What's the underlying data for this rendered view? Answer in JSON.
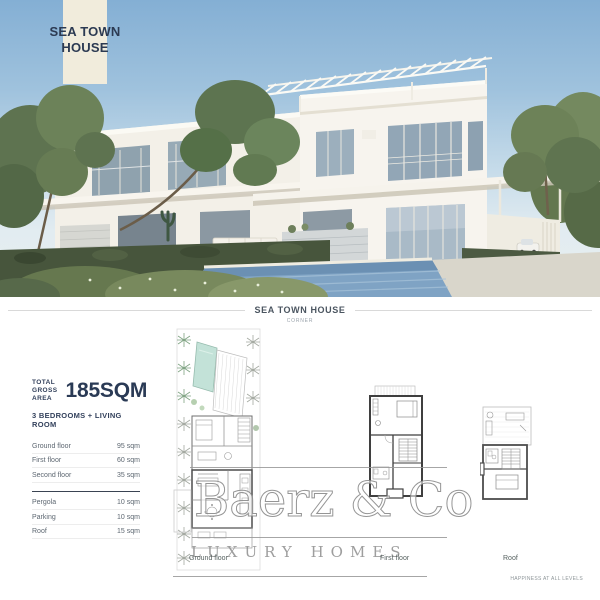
{
  "badge": {
    "title_line1": "SEA TOWN",
    "title_line2": "HOUSE"
  },
  "caption": {
    "title": "SEA TOWN HOUSE",
    "subtitle": "CORNER"
  },
  "summary": {
    "total_label_line1": "TOTAL",
    "total_label_line2": "GROSS AREA",
    "total_value": "185SQM",
    "configuration": "3 BEDROOMS + LIVING ROOM"
  },
  "area_table": {
    "floors": [
      {
        "label": "Ground floor",
        "value": "95 sqm"
      },
      {
        "label": "First floor",
        "value": "60 sqm"
      },
      {
        "label": "Second floor",
        "value": "35 sqm"
      }
    ],
    "extras": [
      {
        "label": "Pergola",
        "value": "10 sqm"
      },
      {
        "label": "Parking",
        "value": "10 sqm"
      },
      {
        "label": "Roof",
        "value": "15 sqm"
      }
    ]
  },
  "floor_plans": [
    {
      "label": "Ground floor"
    },
    {
      "label": "First floor"
    },
    {
      "label": "Roof"
    }
  ],
  "watermark": {
    "brand": "Baerz & Co",
    "tagline": "LUXURY HOMES"
  },
  "footer": {
    "slogan": "HAPPINESS AT ALL LEVELS"
  },
  "colors": {
    "badge_bg": "#f1ecdc",
    "heading_navy": "#2a3a55",
    "plan_pool": "#c3e2d8",
    "photo_pool": "#7fa3c4",
    "sky_top": "#84afd4"
  }
}
